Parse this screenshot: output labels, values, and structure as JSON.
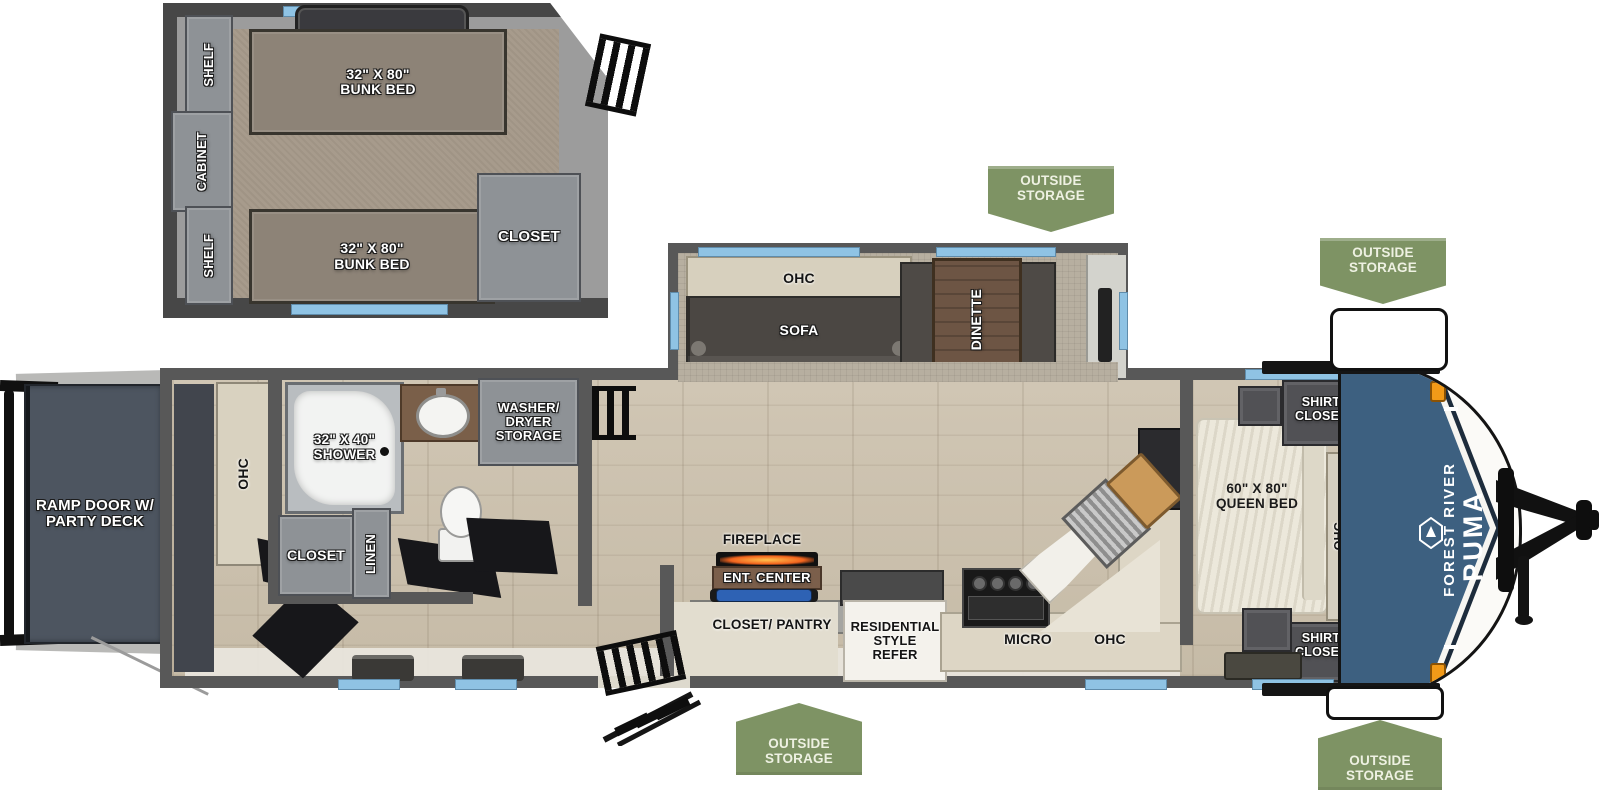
{
  "colors": {
    "banner_green": "#7e9364",
    "cap_blue": "#3d6080",
    "cap_navy": "#1d2c3c",
    "window_blue": "#8fc3e4",
    "marker_orange": "#f29a18",
    "wall_gray": "#585858"
  },
  "banners": {
    "label": "OUTSIDE STORAGE"
  },
  "bunk_room": {
    "shelf_top": "SHELF",
    "cabinet": "CABINET",
    "shelf_bottom": "SHELF",
    "bunk_top": "32\" X 80\" BUNK BED",
    "bunk_bottom": "32\" X 80\" BUNK BED",
    "closet": "CLOSET"
  },
  "exterior": {
    "ramp": "RAMP DOOR W/ PARTY DECK",
    "brand_line1": "FOREST RIVER",
    "brand_line2": "PUMA"
  },
  "garage": {
    "ohc": "OHC"
  },
  "bathroom": {
    "shower": "32\" X 40\" SHOWER",
    "washer_dryer": "WASHER/ DRYER STORAGE",
    "closet": "CLOSET",
    "linen": "LINEN"
  },
  "slide_out": {
    "ohc": "OHC",
    "sofa": "SOFA",
    "dinette": "DINETTE"
  },
  "living": {
    "fireplace": "FIREPLACE",
    "ent_center": "ENT. CENTER",
    "closet_pantry": "CLOSET/ PANTRY"
  },
  "kitchen": {
    "refrigerator": "RESIDENTIAL STYLE REFER",
    "microwave": "MICRO",
    "ohc": "OHC"
  },
  "bedroom": {
    "bed": "60\" X 80\" QUEEN BED",
    "shirt_closet_top": "SHIRT CLOSET",
    "shirt_closet_bottom": "SHIRT CLOSET",
    "ohc": "OHC"
  }
}
